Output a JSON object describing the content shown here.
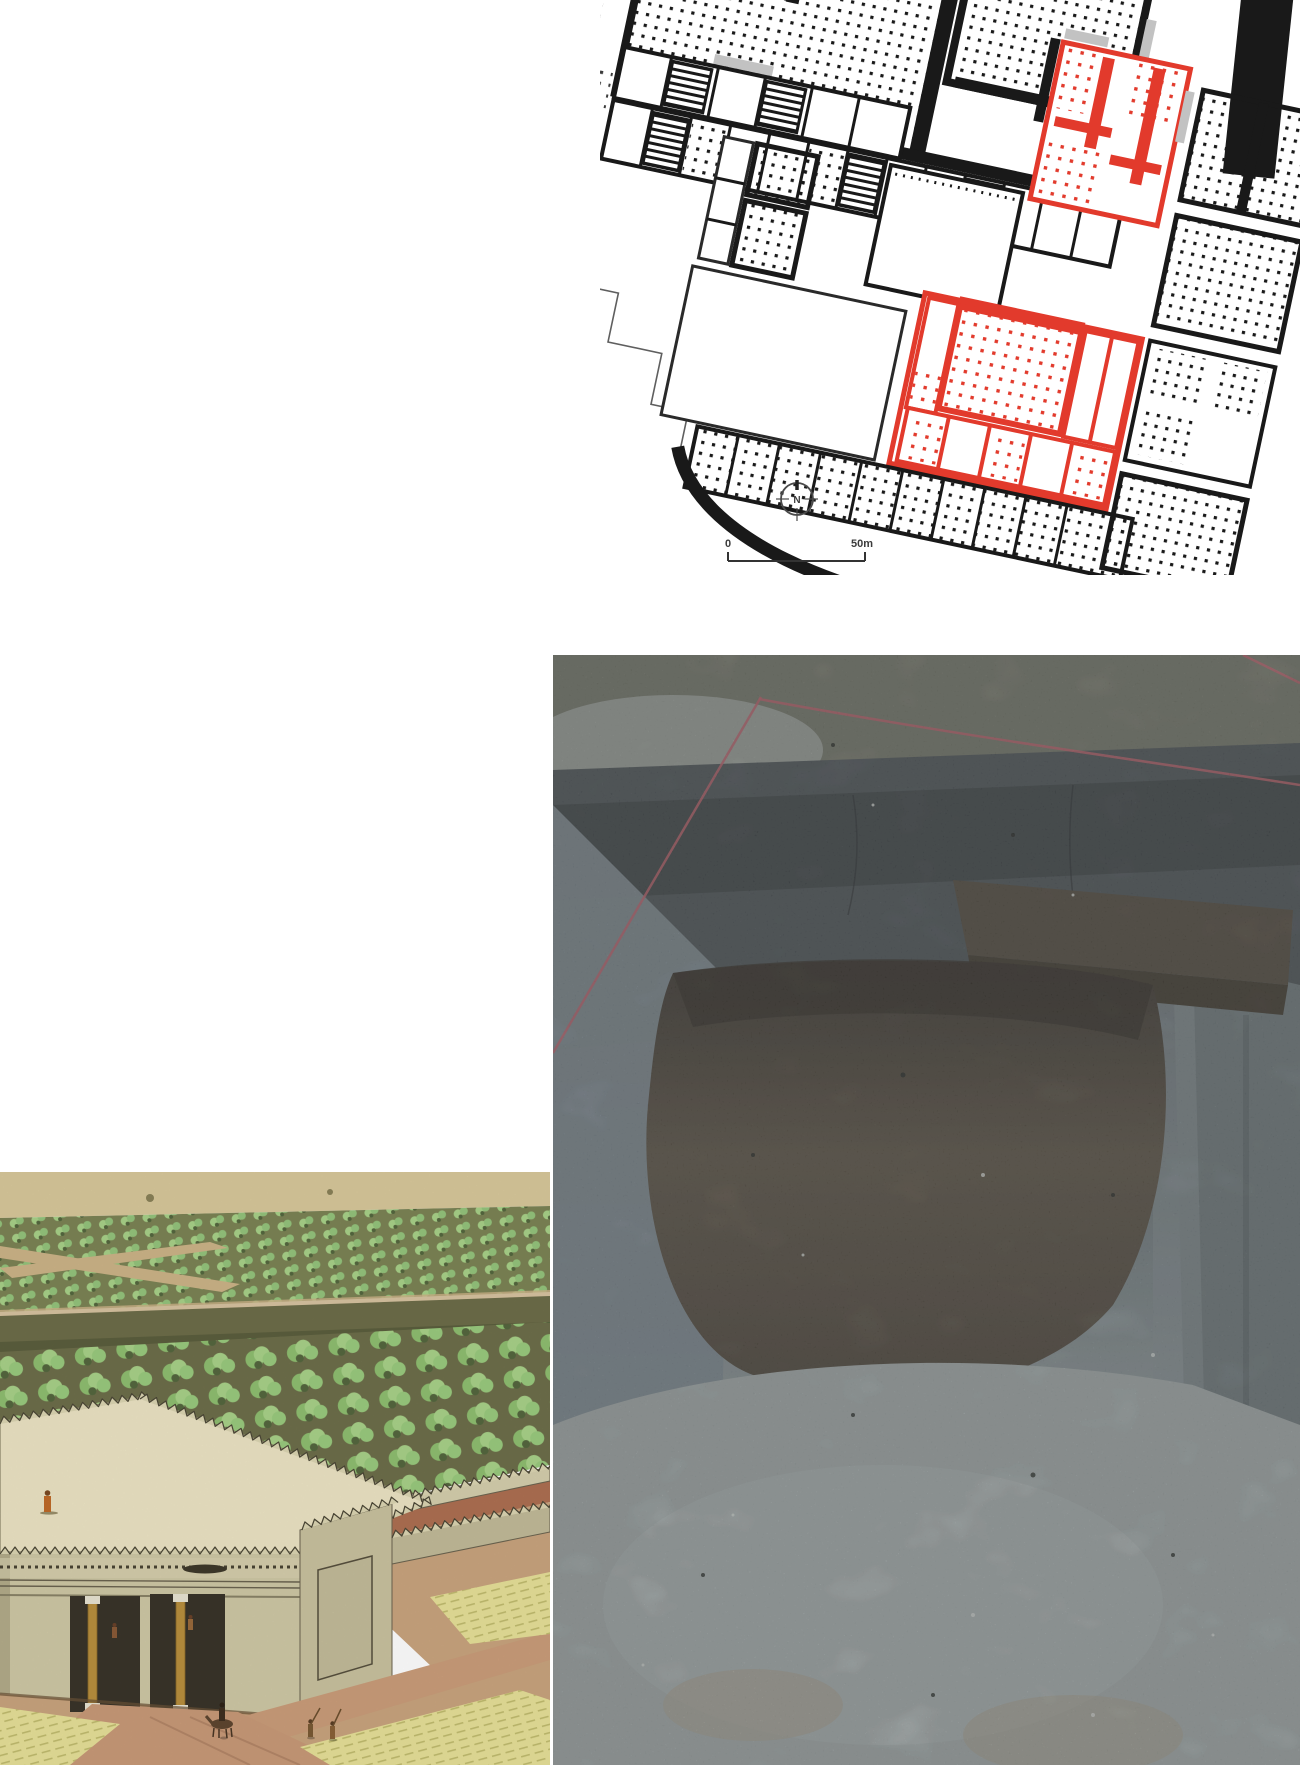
{
  "page": {
    "width": 1300,
    "height": 1765,
    "background": "#ffffff"
  },
  "palette": {
    "red": "#e23a2c",
    "ink": "#191919",
    "outlineGrey": "#5f5f5f",
    "shadowGrey": "#c2c2c2",
    "pink": "#cf6f7a",
    "trenchLight": "#b7c1c2",
    "pitBrown": "#5f584c",
    "groundTan": "#d8c89b",
    "treeGreen": "#a9d289",
    "wallKhaki": "#cdc6a4",
    "roofCream": "#ece4c4",
    "roadTan": "#c89a78",
    "fieldYellow": "#e7e199",
    "robeOrange": "#c06a28"
  },
  "plan_figure": {
    "kind": "archaeological site plan with highlighted suites",
    "north_label": "N",
    "scale_bar": {
      "start_label": "0",
      "end_label": "50m"
    }
  },
  "excavation_figure": {
    "kind": "excavation trench photograph with survey strings"
  },
  "reconstruction_figure": {
    "kind": "reconstruction of walled garden and gatehouse"
  }
}
